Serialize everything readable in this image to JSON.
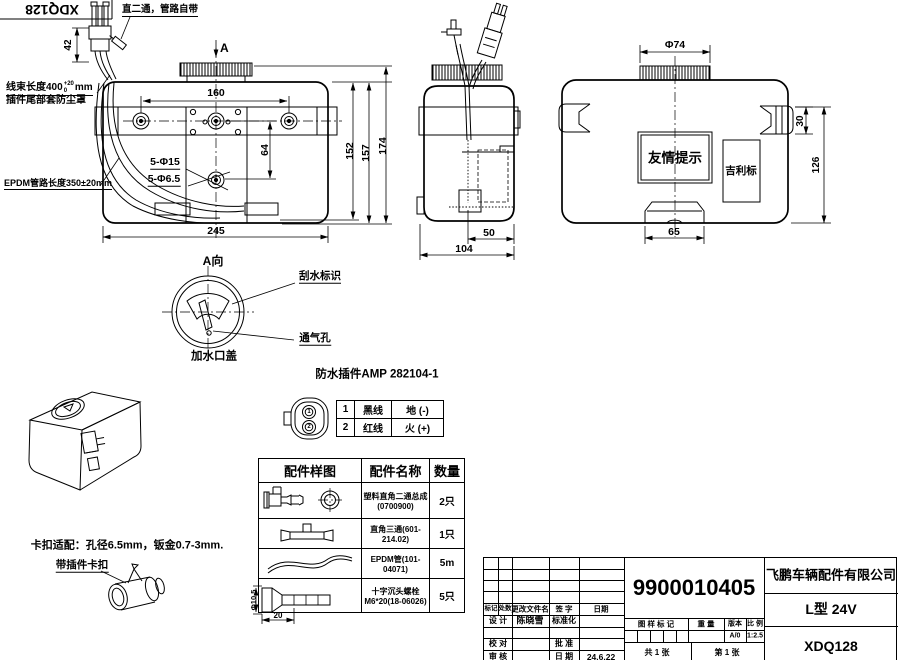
{
  "corner_box": {
    "code": "XDQ128"
  },
  "notes": {
    "fitting": "直二通，管路自带",
    "harness_prefix": "线束长度400",
    "harness_tol_up": "+20",
    "harness_tol_dn": "0",
    "harness_unit": "mm",
    "dust_cap": "插件尾部套防尘罩",
    "epdm": "EPDM管路长度350±20mm",
    "clip_fit": "卡扣适配：孔径6.5mm，钣金0.7-3mm.",
    "clip_label": "带插件卡扣"
  },
  "front_view": {
    "section_mark": "A",
    "view_title": "A向",
    "d42": "42",
    "d160": "160",
    "d64": "64",
    "d152": "152",
    "d157": "157",
    "d174": "174",
    "d245": "245",
    "holes_15": "5-Φ15",
    "holes_65": "5-Φ6.5"
  },
  "side_view": {
    "d50": "50",
    "d104": "104"
  },
  "rear_view": {
    "cap_dia": "Φ74",
    "d30": "30",
    "d126": "126",
    "d65": "65",
    "notice": "友情提示",
    "brand": "吉利标"
  },
  "a_view": {
    "wiper": "刮水标识",
    "vent": "通气孔",
    "cap": "加水口盖"
  },
  "connector": {
    "title": "防水插件AMP 282104-1",
    "pins": [
      {
        "no": "1",
        "wire": "黑线",
        "polarity": "地 (-)"
      },
      {
        "no": "2",
        "wire": "红线",
        "polarity": "火 (+)"
      }
    ]
  },
  "parts_table": {
    "headers": [
      "配件样图",
      "配件名称",
      "数量"
    ],
    "rows": [
      {
        "line1": "塑料直角二通总成",
        "line2": "(0700900)",
        "qty": "2只"
      },
      {
        "line1": "直角三通(601-214.02)",
        "line2": "",
        "qty": "1只"
      },
      {
        "line1": "EPDM管(101-04071)",
        "line2": "",
        "qty": "5m"
      },
      {
        "line1": "十字沉头螺栓",
        "line2": "M6*20(18-06026)",
        "qty": "5只"
      }
    ],
    "screw_dia": "Φ10.5",
    "screw_len": "20"
  },
  "title_block": {
    "part_number": "9900010405",
    "company": "飞鹏车辆配件有限公司",
    "model": "L型 24V",
    "drawing_no": "XDQ128",
    "h_mark": "标记",
    "h_count": "处数",
    "h_file": "更改文件名",
    "h_sign": "签 字",
    "h_date": "日期",
    "design": "设 计",
    "designer": "陈晓雪",
    "standardize": "标准化",
    "check": "校 对",
    "approve": "批 准",
    "review": "审 核",
    "date_label": "日 期",
    "date": "24.6.22",
    "mark_hdr": "图 样 标 记",
    "weight_hdr": "重 量",
    "version_hdr": "版本",
    "scale_hdr": "比 例",
    "version": "A/0",
    "scale": "1:2.5",
    "sheet_total": "共 1 张",
    "sheet_no": "第 1 张"
  }
}
